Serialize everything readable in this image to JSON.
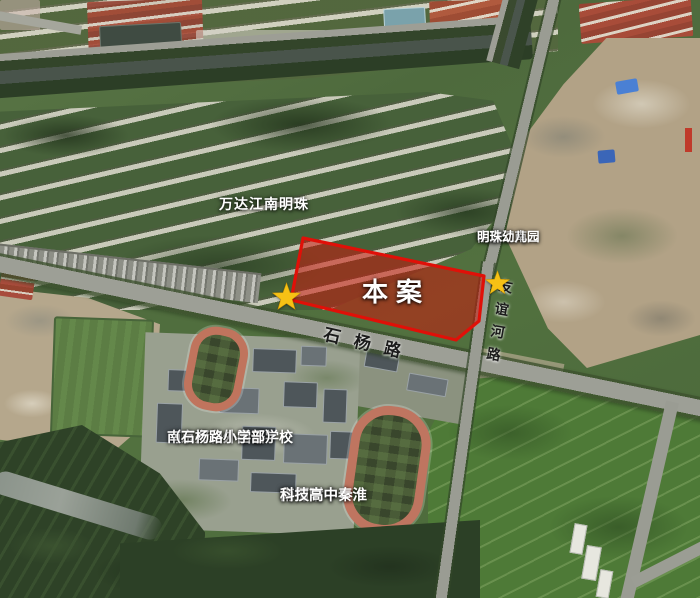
{
  "map": {
    "annotations": {
      "site_label": "本案",
      "road_shiyang": "石杨路",
      "road_youyi": "友谊河路",
      "poi_wanda": "万达江南明珠",
      "poi_kindergarten": [
        "南京江南",
        "明珠幼儿园"
      ],
      "poi_primary": [
        "南京郑和外国语学校",
        "（石杨路小学部）"
      ],
      "poi_highschool": [
        "南师附中秦淮",
        "科技高中"
      ]
    },
    "colors": {
      "site_fill": "rgba(201,26,12,0.55)",
      "site_stroke": "#e01008",
      "star_fill": "#f6c115",
      "star_stroke": "#cf9400"
    }
  }
}
